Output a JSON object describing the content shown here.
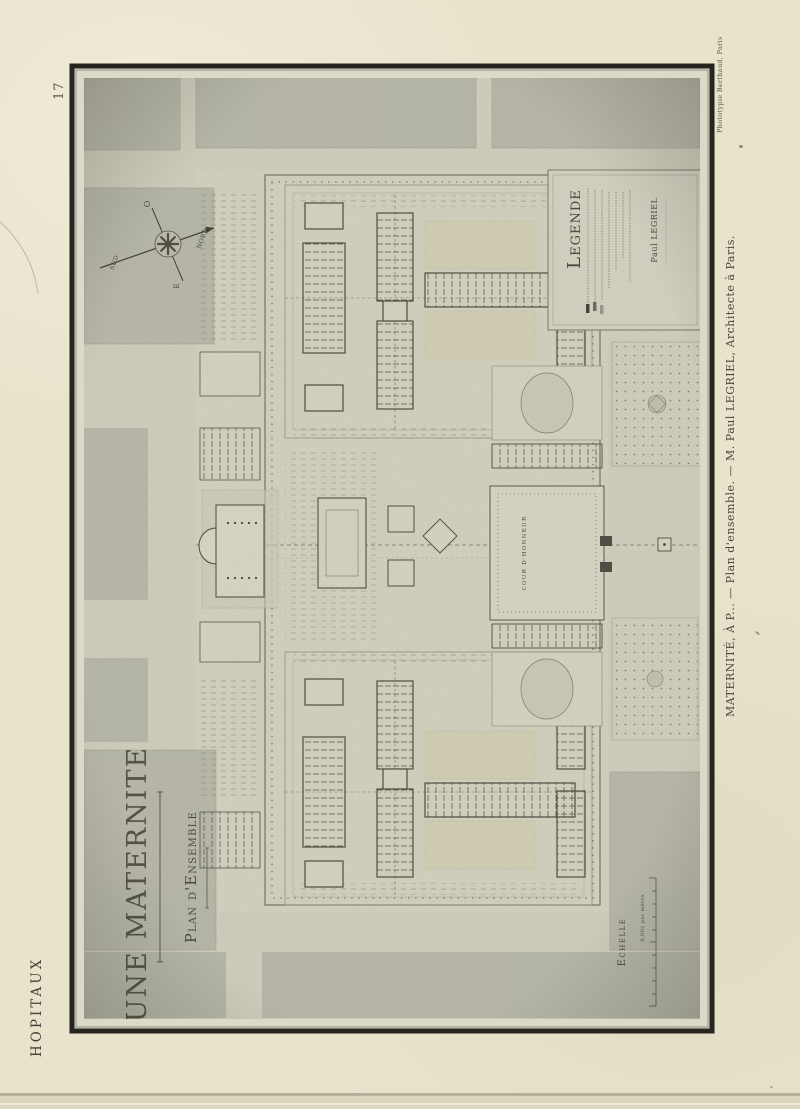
{
  "page": {
    "number": "17",
    "series_title": "HOPITAUX",
    "caption": "MATERNITÉ, À P... — Plan d'ensemble. — M. Paul LEGRIEL, Architecte à Paris.",
    "printer_credit": "Phototypie Berthaud, Paris"
  },
  "plate": {
    "title": "UNE MATERNITE",
    "subtitle": "Plan d'Ensemble",
    "legend": {
      "heading": "Legende",
      "signature": "Paul LEGRIEL"
    },
    "scale": {
      "label": "Echelle",
      "note": "0,002 par mètre"
    },
    "labels": {
      "cour_honneur": "COUR D'HONNEUR"
    },
    "compass": {
      "north": "NORD",
      "south": "SUD",
      "east": "E",
      "west": "O"
    },
    "colors": {
      "paper": "#e9e3cc",
      "plate_ground": "#d4d2c1",
      "wash_block": "#b6b6a9",
      "ink": "#3c3b32",
      "frame": "#25241e"
    }
  }
}
